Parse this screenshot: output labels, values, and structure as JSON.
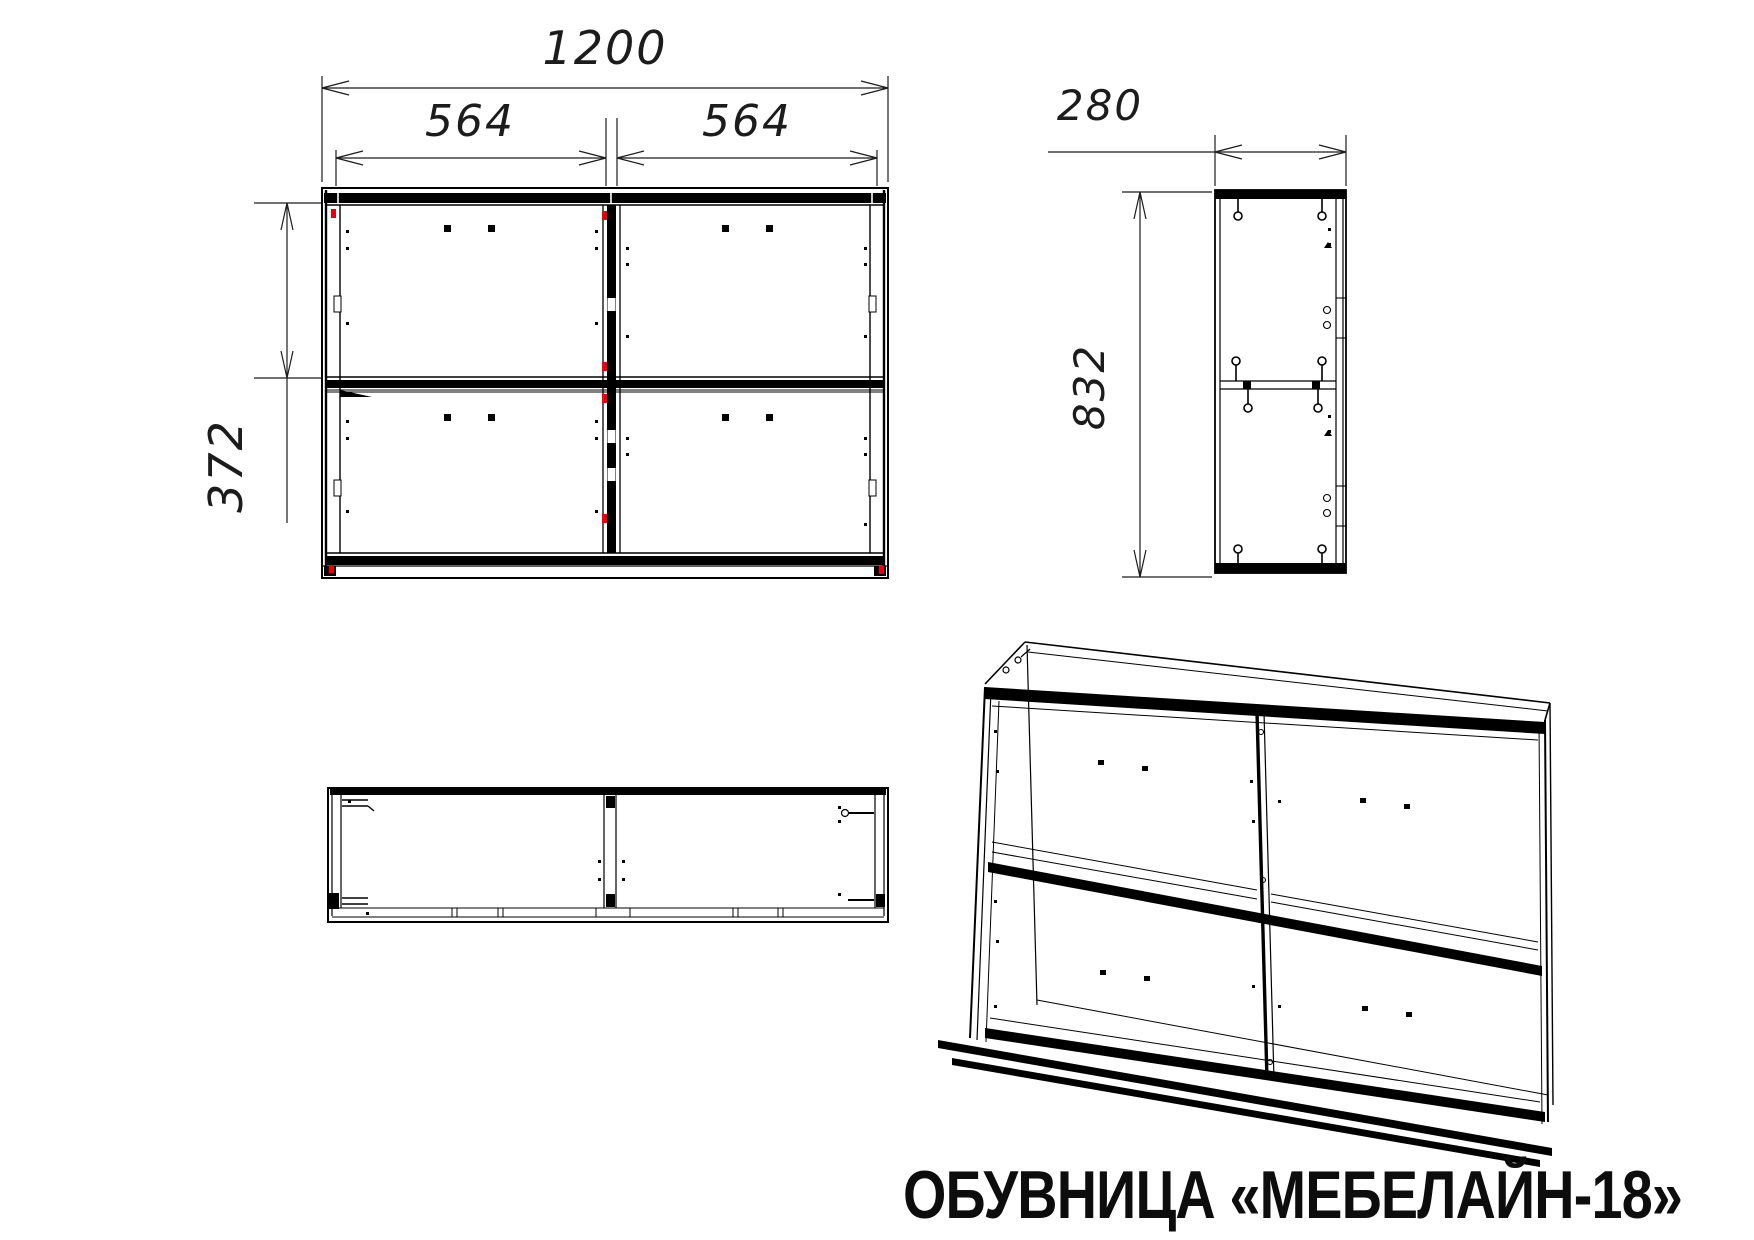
{
  "drawing_title": "ОБУВНИЦА «МЕБЕЛАЙН-18»",
  "dimensions": {
    "front": {
      "total_width": "1200",
      "left_section_width": "564",
      "right_section_width": "564",
      "section_height": "372"
    },
    "side": {
      "depth": "280",
      "height": "832"
    }
  },
  "colors": {
    "line": "#000000",
    "accent": "#e8000d",
    "background": "#ffffff"
  }
}
